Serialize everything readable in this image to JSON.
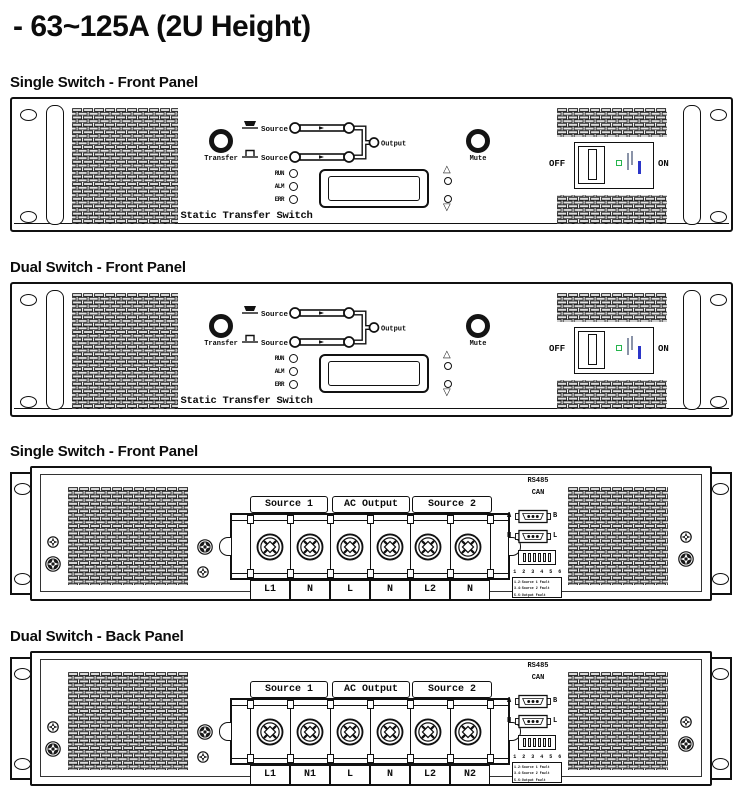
{
  "title": "- 63~125A (2U Height)",
  "sections": [
    {
      "label": "Single Switch - Front Panel",
      "type": "front"
    },
    {
      "label": "Dual Switch - Front Panel",
      "type": "front"
    },
    {
      "label": "Single Switch - Front Panel",
      "type": "back",
      "terminals": [
        "L1",
        "N",
        "L",
        "N",
        "L2",
        "N"
      ]
    },
    {
      "label": "Dual Switch - Back Panel",
      "type": "back",
      "terminals": [
        "L1",
        "N1",
        "L",
        "N",
        "L2",
        "N2"
      ]
    }
  ],
  "front_panel": {
    "transfer_label": "Transfer",
    "mute_label": "Mute",
    "source1_label": "Source 1",
    "source2_label": "Source 2",
    "output_label": "Output",
    "led_labels": [
      "RUN",
      "ALM",
      "ERR"
    ],
    "device_name": "Static Transfer Switch",
    "breaker_off": "OFF",
    "breaker_on": "ON"
  },
  "back_panel": {
    "group_headers": [
      "Source 1",
      "AC Output",
      "Source 2"
    ],
    "rs485_label": "RS485",
    "can_label": "CAN",
    "port1_left": "A",
    "port1_right": "B",
    "port2_left": "H",
    "port2_right": "L",
    "dip_numbers": "1 2 3 4 5 6",
    "legend_rows": [
      "1.2:Source 1 Fault",
      "3.4:Source 2 Fault",
      "5.6:Output Fault"
    ]
  },
  "colors": {
    "line": "#111111",
    "breaker_led_green": "#26b44d",
    "breaker_mark_blue": "#2b35c8",
    "vent_fill": "#e2e2e2"
  }
}
